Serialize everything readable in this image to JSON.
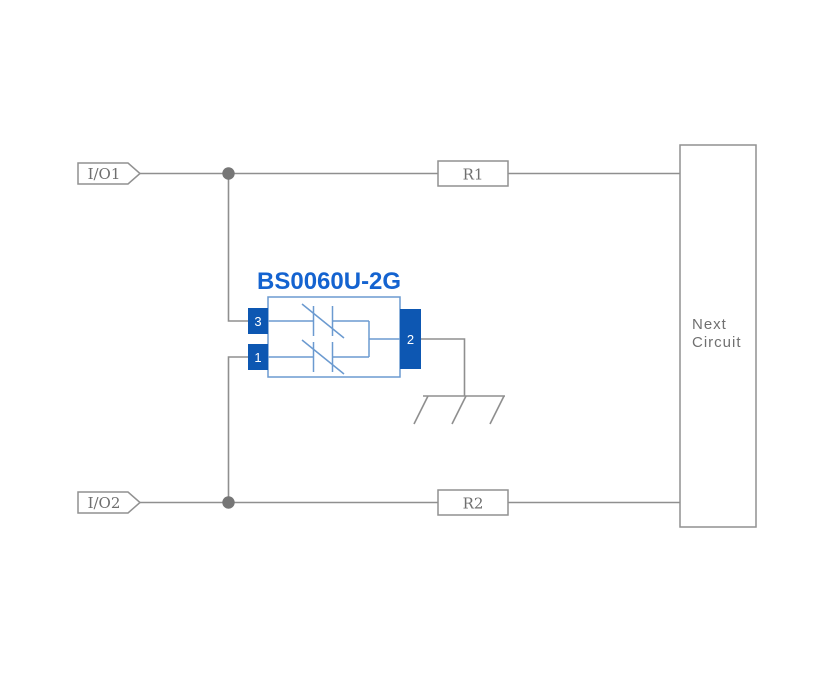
{
  "diagram": {
    "component": {
      "title": "BS0060U-2G",
      "pin_3": "3",
      "pin_1": "1",
      "pin_2": "2"
    },
    "io_tags": {
      "io1": "I/O1",
      "io2": "I/O2"
    },
    "resistors": {
      "r1": "R1",
      "r2": "R2"
    },
    "next_circuit": {
      "line1": "Next",
      "line2": "Circuit"
    },
    "colors": {
      "pin_fill_blue": "#0d57b2",
      "title_blue": "#1463d0",
      "component_outline_blue": "#6b9ad0",
      "wire_gray": "#8f8f8f",
      "label_gray": "#6f6f6f",
      "background": "#ffffff"
    }
  }
}
